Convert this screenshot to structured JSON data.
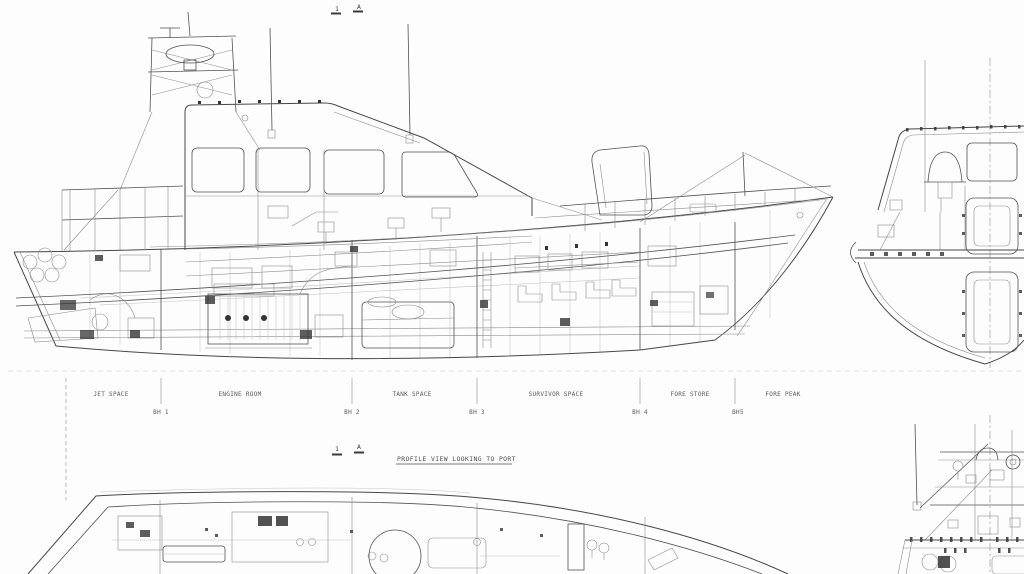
{
  "drawing": {
    "title": "PROFILE VIEW LOOKING TO PORT",
    "section_markers": {
      "number": "1",
      "letter": "A"
    },
    "compartments": [
      "JET SPACE",
      "ENGINE ROOM",
      "TANK SPACE",
      "SURVIVOR SPACE",
      "FORE STORE",
      "FORE PEAK"
    ],
    "bulkheads": [
      "BH 1",
      "BH 2",
      "BH 3",
      "BH 4",
      "BH5"
    ],
    "colors": {
      "background": "#fdfdfd",
      "ink_main": "#474747",
      "ink_light": "#8d8d8d",
      "ink_faint": "#c3c3c3",
      "label_text": "#5a5a5a"
    }
  }
}
